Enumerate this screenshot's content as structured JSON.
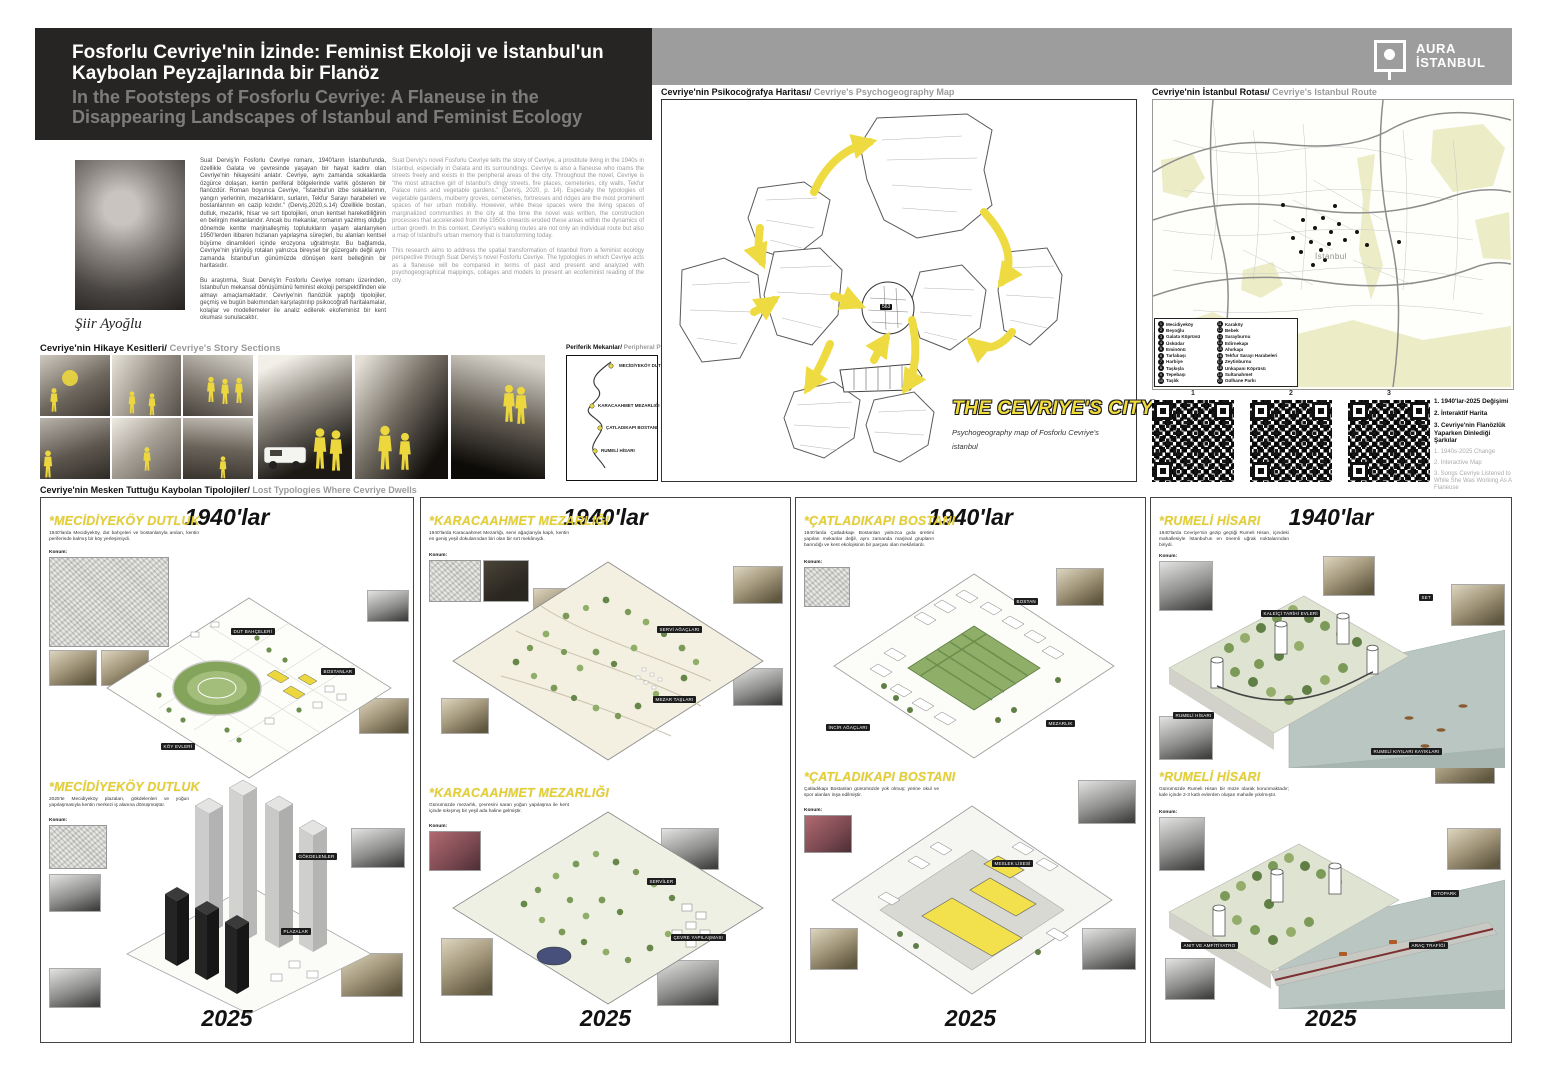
{
  "header": {
    "title_tr_line1": "Fosforlu Cevriye'nin İzinde: Feminist Ekoloji ve İstanbul'un",
    "title_tr_line2": "Kaybolan Peyzajlarında bir Flanöz",
    "title_en_line1": "In the Footsteps of Fosforlu Cevriye: A Flaneuse in the",
    "title_en_line2": "Disappearing Landscapes of Istanbul and Feminist Ecology",
    "logo_line1": "AURA",
    "logo_line2": "İSTANBUL"
  },
  "author": {
    "name": "Şiir Ayoğlu"
  },
  "intro": {
    "tr_p1": "Suat Derviş'in Fosforlu Cevriye romanı, 1940'ların İstanbul'unda, özellikle Galata ve çevresinde yaşayan bir hayat kadını olan Cevriye'nin hikayesini anlatır. Cevriye, aynı zamanda sokaklarda özgürce dolaşan, kentin periferal bölgelerinde varlık gösteren bir flanözdür. Roman boyunca Cevriye, \"İstanbul'un izbe sokaklarının, yangın yerlerinin, mezarlıkların, surların, Tekfur Sarayı harabeleri ve bostanlarının en cazip kızıdır.\" (Derviş,2020,s.14) Özellikle bostan, dutluk, mezarlık, hisar ve sırt tipolojileri, onun kentsel hareketliliğinin en belirgin mekanlarıdır. Ancak bu mekanlar, romanın yazılmış olduğu dönemde kentte marjinalleşmiş toplulukların yaşam alanlarıyken 1950'lerden itibaren hızlanan yapılaşma süreçleri, bu alanları kentsel büyüme dinamikleri içinde erozyona uğratmıştır. Bu bağlamda, Cevriye'nin yürüyüş rotaları yalnızca bireysel bir güzergahı değil aynı zamanda İstanbul'un günümüzde dönüşen kent belleğinin bir haritasıdır.",
    "tr_p2": "Bu araştırma, Suat Derviş'in Fosforlu Cevriye romanı üzerinden, İstanbul'un mekansal dönüşümünü feminist ekoloji perspektifinden ele almayı amaçlamaktadır. Cevriye'nin flanözlük yaptığı tipolojiler, geçmiş ve bugün bakımından karşılaştırılıp psikocoğrafi haritalamalar, kolajlar ve modellemeler ile analiz edilerek ekofeminist bir kent okuması sunulacaktır.",
    "en_p1": "Suat Derviş's novel Fosforlu Cevriye tells the story of Cevriye, a prostitute living in the 1940s in Istanbul, especially in Galata and its surroundings. Cevriye is also a flaneuse who roams the streets freely and exists in the peripheral areas of the city. Throughout the novel, Cevriye is \"the most attractive girl of Istanbul's dingy streets, fire places, cemeteries, city walls, Tekfur Palace ruins and vegetable gardens.\" (Derviş, 2020, p. 14). Especially the typologies of vegetable gardens, mulberry groves, cemeteries, fortresses and ridges are the most prominent spaces of her urban mobility. However, while these spaces were the living spaces of marginalized communities in the city at the time the novel was written, the construction processes that accelerated from the 1950s onwards eroded these areas within the dynamics of urban growth. In this context, Cevriye's walking routes are not only an individual route but also a map of Istanbul's urban memory that is transforming today.",
    "en_p2": "This research aims to address the spatial transformation of Istanbul from a feminist ecology perspective through Suat Derviş's novel Fosforlu Cevriye. The typologies in which Cevriye acts as a flaneuse will be compared in terms of past and present and analyzed with psychogeographical mappings, collages and models to present an ecofeminist reading of the city."
  },
  "story_sections": {
    "label_tr": "Cevriye'nin Hikaye Kesitleri/",
    "label_en": " Cevriye's Story Sections"
  },
  "peripheral": {
    "label_tr": "Periferik Mekanlar/",
    "label_en": " Peripheral Places",
    "stops": [
      "MECİDİYEKÖY DUTLUK",
      "KARACAAHMET MEZARLIĞI",
      "ÇATLADIKAPI BOSTANI",
      "RUMELİ HİSARI"
    ]
  },
  "psychogeography": {
    "label_tr": "Cevriye'nin Psikocoğrafya Haritası/",
    "label_en": " Cevriye's Psychogeography Map",
    "city_title": "THE CEVRIYE'S CITY",
    "city_subtitle": "Psychogeography map of Fosforlu Cevriye's istanbul",
    "inset_label": "563"
  },
  "route_map": {
    "label_tr": "Cevriye'nin İstanbul Rotası/",
    "label_en": " Cevriye's Istanbul Route",
    "center_label": "İstanbul",
    "legend": [
      {
        "n": "1",
        "t": "Mecidiyeköy"
      },
      {
        "n": "2",
        "t": "Beyoğlu"
      },
      {
        "n": "3",
        "t": "Galata Köprüsü"
      },
      {
        "n": "4",
        "t": "Üsküdar"
      },
      {
        "n": "5",
        "t": "Eminönü"
      },
      {
        "n": "6",
        "t": "Tarlabaşı"
      },
      {
        "n": "7",
        "t": "Harbiye"
      },
      {
        "n": "8",
        "t": "Taşkışla"
      },
      {
        "n": "9",
        "t": "Tepebaşı"
      },
      {
        "n": "10",
        "t": "Taşlık"
      },
      {
        "n": "11",
        "t": "Karaköy"
      },
      {
        "n": "12",
        "t": "Bebek"
      },
      {
        "n": "13",
        "t": "Sarayburnu"
      },
      {
        "n": "14",
        "t": "Edirnekapı"
      },
      {
        "n": "15",
        "t": "Ahırkapı"
      },
      {
        "n": "16",
        "t": "Tekfur Sarayı Harabeleri"
      },
      {
        "n": "17",
        "t": "Zeytinburnu"
      },
      {
        "n": "18",
        "t": "Unkapanı Köprüsü"
      },
      {
        "n": "19",
        "t": "Sultanahmet"
      },
      {
        "n": "20",
        "t": "Gülhane Parkı"
      }
    ]
  },
  "qr": {
    "nums": [
      "1",
      "2",
      "3"
    ],
    "tr": [
      "1. 1940'lar-2025 Değişimi",
      "2. İnteraktif Harita",
      "3. Cevriye'nin Flanözlük Yaparken Dinlediği Şarkılar"
    ],
    "en": [
      "1. 1940s-2025 Change",
      "2. Interactive Map",
      "3. Songs Cevriye Listened to While She Was Working As A Flaneuse"
    ]
  },
  "typologies": {
    "label_tr": "Cevriye'nin Mesken Tuttuğu Kaybolan Tipolojiler/",
    "label_en": " Lost Typologies Where Cevriye Dwells",
    "era_1940": "1940'lar",
    "era_2025": "2025",
    "konum_label": "Konum:",
    "panels": [
      {
        "title": "*MECİDİYEKÖY DUTLUK",
        "desc_1940": "1940'larda Mecidiyeköy, dut bahçeleri ve bostanlarıyla anılan, kentin periferinde kalmış bir köy yerleşimiydi.",
        "desc_2025": "2025'te Mecidiyeköy plazaları, gökdelenleri ve yoğun yapılaşmasıyla kentin merkezi iş alanına dönüşmüştür.",
        "callouts_1940": [
          "DUT BAHÇELERİ",
          "BOSTANLAR",
          "KÖY EVLERİ"
        ],
        "callouts_2025": [
          "GÖKDELENLER",
          "PLAZALAR"
        ]
      },
      {
        "title": "*KARACAAHMET MEZARLIĞI",
        "desc_1940": "1940'larda Karacaahmet Mezarlığı, servi ağaçlarıyla kaplı, kentin en geniş yeşil dokularından biri olan bir sırt mekânıydı.",
        "desc_2025": "Günümüzde mezarlık, çevresini saran yoğun yapılaşma ile kent içinde sıkışmış bir yeşil ada haline gelmiştir.",
        "callouts_1940": [
          "SERVİ AĞAÇLARI",
          "MEZAR TAŞLARI"
        ],
        "callouts_2025": [
          "SERVİLER",
          "ÇEVRE YAPILAŞMASI"
        ]
      },
      {
        "title": "*ÇATLADIKAPI BOSTANI",
        "desc_1940": "1940'larda Çatladıkapı Bostanları yalnızca gıda üretimi yapılan mekanlar değil, aynı zamanda marjinal grupların barındığı ve kent ekolojisinin bir parçası olan mekânlardı.",
        "desc_2025": "Çatladıkapı Bostanları günümüzde yok olmuş; yerine okul ve spor alanları inşa edilmiştir.",
        "callouts_1940": [
          "BOSTAN",
          "İNCİR AĞAÇLARI",
          "MEZARLIK"
        ],
        "callouts_2025": [
          "MESLEK LİSESİ"
        ]
      },
      {
        "title": "*RUMELİ HİSARI",
        "desc_1940": "1940'larda Cevriye'nin gezip geçtiği Rumeli Hisarı, içindeki mahallesiyle İstanbul'un en önemli uğrak noktalarından biriydi.",
        "desc_2025": "Günümüzde Rumeli Hisarı bir müze olarak korunmaktadır; kale içinde 2-3 katlı evlerden oluşan mahalle yıkılmıştır.",
        "callouts_1940": [
          "KALEİÇİ TARİHİ EVLERİ",
          "SET",
          "RUMELİ HİSARI",
          "RUMELİ KIYILARI KAYIKLARI"
        ],
        "callouts_2025": [
          "OTOPARK",
          "ANIT VE AMFİTİYATRO",
          "ARAÇ TRAFİĞİ"
        ]
      }
    ]
  }
}
